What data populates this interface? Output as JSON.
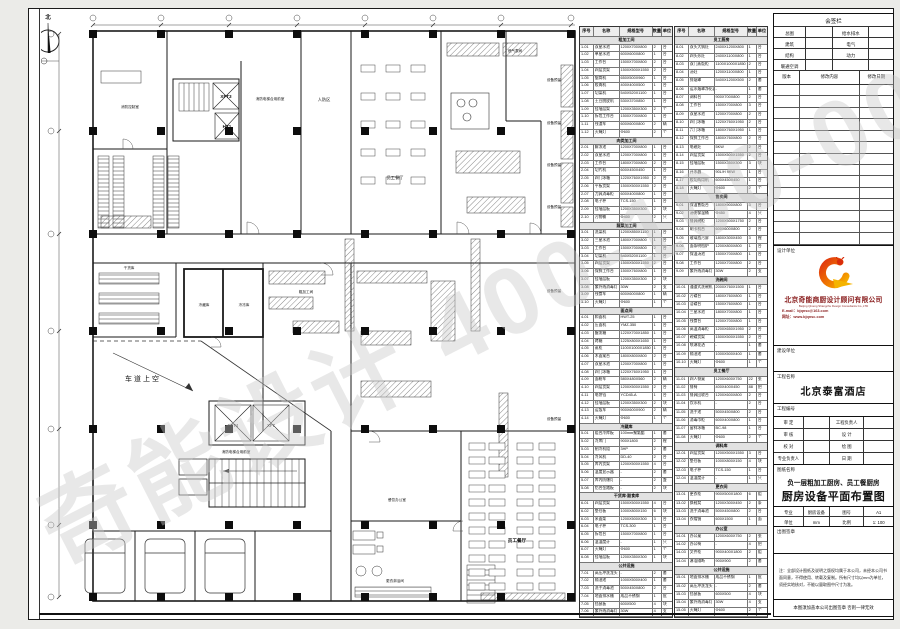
{
  "watermark": {
    "text": "奇能设计 400-100-0086"
  },
  "plan": {
    "labels": [
      {
        "t": "北"
      },
      {
        "t": "消防控制室"
      },
      {
        "t": "XFT3"
      },
      {
        "t": "HT1"
      },
      {
        "t": "消防电梯合用前室"
      },
      {
        "t": "人防区"
      },
      {
        "t": "燃气表间"
      },
      {
        "t": "员工餐厅"
      },
      {
        "t": "干货库"
      },
      {
        "t": "冷藏库"
      },
      {
        "t": "冷冻库"
      },
      {
        "t": "粗加工间"
      },
      {
        "t": "车道上空"
      },
      {
        "t": "XFT4"
      },
      {
        "t": "XF7"
      },
      {
        "t": "消防电梯合用前室"
      },
      {
        "t": "餐饮办公室"
      },
      {
        "t": "更衣淋浴间"
      },
      {
        "t": "员工餐厅"
      },
      {
        "t": "设备预留"
      },
      {
        "t": "设备预留"
      },
      {
        "t": "设备预留"
      },
      {
        "t": "设备预留"
      },
      {
        "t": "设备预留"
      },
      {
        "t": "设备预留"
      }
    ]
  },
  "schedule": {
    "headers": [
      "序号",
      "名称",
      "规格型号",
      "数量",
      "单位"
    ],
    "table1_rows": [
      [
        "粗加工间"
      ],
      [
        "1-01",
        "双星水池",
        "1200X700X800",
        "2",
        "台"
      ],
      [
        "1-02",
        "单星水池",
        "600X600X800",
        "1",
        "台"
      ],
      [
        "1-03",
        "工作台",
        "1500X700X800",
        "2",
        "台"
      ],
      [
        "1-04",
        "四层货架",
        "1500X500X1550",
        "2",
        "台"
      ],
      [
        "1-05",
        "锯骨机",
        "650X500X960",
        "1",
        "台"
      ],
      [
        "1-06",
        "绞肉机",
        "400X400X500",
        "1",
        "台"
      ],
      [
        "1-07",
        "切菜机",
        "540X520X1100",
        "1",
        "台"
      ],
      [
        "1-08",
        "土豆脱皮机",
        "530X370X850",
        "1",
        "台"
      ],
      [
        "1-09",
        "挂墙层架",
        "1200X350X300",
        "2",
        "个"
      ],
      [
        "1-10",
        "拆包工作台",
        "1500X700X800",
        "1",
        "台"
      ],
      [
        "1-11",
        "残渣车",
        "600X600X800",
        "2",
        "辆"
      ],
      [
        "1-12",
        "灭蝇灯",
        "Φ600",
        "2",
        "个"
      ],
      [
        "肉类加工间"
      ],
      [
        "2-01",
        "解冻池",
        "1200X700X800",
        "1",
        "台"
      ],
      [
        "2-02",
        "双星水池",
        "1200X700X800",
        "1",
        "台"
      ],
      [
        "2-03",
        "工作台",
        "1800X700X800",
        "2",
        "台"
      ],
      [
        "2-04",
        "切片机",
        "600X450X450",
        "1",
        "台"
      ],
      [
        "2-05",
        "四门冰箱",
        "1220X760X1950",
        "2",
        "台"
      ],
      [
        "2-06",
        "平板货架",
        "1500X500X1550",
        "2",
        "台"
      ],
      [
        "2-07",
        "刀具消毒柜",
        "600X400X800",
        "1",
        "台"
      ],
      [
        "2-08",
        "电子秤",
        "TCS-150",
        "1",
        "台"
      ],
      [
        "2-09",
        "挂墙层板",
        "1200X350X300",
        "2",
        "块"
      ],
      [
        "2-10",
        "污物桶",
        "Φ400",
        "2",
        "只"
      ],
      [
        "蔬菜加工间"
      ],
      [
        "3-01",
        "洗菜机",
        "1200X850X1150",
        "1",
        "台"
      ],
      [
        "3-02",
        "三星水池",
        "1800X700X800",
        "1",
        "台"
      ],
      [
        "3-03",
        "工作台",
        "1500X700X800",
        "2",
        "台"
      ],
      [
        "3-04",
        "切菜机",
        "540X520X1100",
        "1",
        "台"
      ],
      [
        "3-05",
        "四层货架",
        "1500X500X1550",
        "2",
        "台"
      ],
      [
        "3-06",
        "保鲜工作台",
        "1500X760X800",
        "1",
        "台"
      ],
      [
        "3-07",
        "挂墙层板",
        "1200X350X300",
        "2",
        "块"
      ],
      [
        "3-08",
        "紫外线消毒灯",
        "30W",
        "2",
        "支"
      ],
      [
        "3-09",
        "残食车",
        "600X600X800",
        "1",
        "辆"
      ],
      [
        "3-10",
        "灭蝇灯",
        "Φ600",
        "1",
        "个"
      ],
      [
        "面点间"
      ],
      [
        "4-01",
        "和面机",
        "HWT-25",
        "1",
        "台"
      ],
      [
        "4-02",
        "压面机",
        "YMZ-350",
        "1",
        "台"
      ],
      [
        "4-03",
        "醒发箱",
        "1220X700X1850",
        "1",
        "台"
      ],
      [
        "4-04",
        "烤箱",
        "1225X800X1650",
        "1",
        "台"
      ],
      [
        "4-05",
        "蒸柜",
        "1100X1000X1850",
        "1",
        "台"
      ],
      [
        "4-06",
        "木面案台",
        "1800X800X800",
        "2",
        "台"
      ],
      [
        "4-07",
        "双星水池",
        "1200X700X800",
        "1",
        "台"
      ],
      [
        "4-08",
        "四门冰箱",
        "1220X760X1950",
        "1",
        "台"
      ],
      [
        "4-09",
        "面粉车",
        "580X480X560",
        "2",
        "辆"
      ],
      [
        "4-10",
        "四层货架",
        "1200X500X1550",
        "2",
        "台"
      ],
      [
        "4-11",
        "电饼铛",
        "YCD45-A",
        "1",
        "台"
      ],
      [
        "4-12",
        "挂墙层板",
        "1200X350X300",
        "2",
        "块"
      ],
      [
        "4-13",
        "运饭车",
        "900X600X900",
        "2",
        "辆"
      ],
      [
        "4-14",
        "灭蝇灯",
        "Φ600",
        "1",
        "个"
      ],
      [
        "冷藏库"
      ],
      [
        "5-01",
        "组合冷库板",
        "100mm聚氨酯",
        "1",
        "套"
      ],
      [
        "5-02",
        "冷库门",
        "900X1800",
        "2",
        "樘"
      ],
      [
        "5-03",
        "制冷机组",
        "3HP",
        "2",
        "套"
      ],
      [
        "5-04",
        "冷风机",
        "DD-40",
        "2",
        "台"
      ],
      [
        "5-05",
        "库内货架",
        "1200X500X1550",
        "4",
        "台"
      ],
      [
        "5-06",
        "温度显示器",
        "-",
        "2",
        "套"
      ],
      [
        "5-07",
        "库内防爆灯",
        "-",
        "2",
        "盏"
      ],
      [
        "5-08",
        "铝合金踏板",
        "-",
        "2",
        "块"
      ],
      [
        "干货库·副食库"
      ],
      [
        "6-01",
        "四层货架",
        "1500X500X1550",
        "4",
        "台"
      ],
      [
        "6-02",
        "垫仓板",
        "1000X800X150",
        "6",
        "块"
      ],
      [
        "6-03",
        "米面架",
        "1200X500X300",
        "3",
        "台"
      ],
      [
        "6-04",
        "电子秤",
        "TCS-300",
        "1",
        "台"
      ],
      [
        "6-05",
        "拆包台",
        "1500X700X800",
        "1",
        "台"
      ],
      [
        "6-06",
        "温湿度计",
        "-",
        "1",
        "只"
      ],
      [
        "6-07",
        "灭蝇灯",
        "Φ600",
        "1",
        "个"
      ],
      [
        "6-08",
        "挂墙层板",
        "1200X350X300",
        "1",
        "块"
      ],
      [
        "公共设施"
      ],
      [
        "7-01",
        "高压冲洗龙头",
        "-",
        "2",
        "套"
      ],
      [
        "7-02",
        "隔油池",
        "1000X500X400",
        "1",
        "套"
      ],
      [
        "7-03",
        "洗手消毒池",
        "500X450X800",
        "2",
        "台"
      ],
      [
        "7-04",
        "地面排水槽",
        "成品不锈钢",
        "1",
        "批"
      ],
      [
        "7-05",
        "挡鼠板",
        "600X500",
        "4",
        "块"
      ],
      [
        "7-06",
        "紫外线消毒灯",
        "30W",
        "4",
        "支"
      ]
    ],
    "table2_rows": [
      [
        "员工厨房"
      ],
      [
        "8-01",
        "双头大锅灶",
        "2400X1200X800",
        "1",
        "台"
      ],
      [
        "8-02",
        "四头炒灶",
        "2400X1100X800",
        "1",
        "台"
      ],
      [
        "8-03",
        "双门蒸饭柜",
        "1100X1000X1850",
        "2",
        "台"
      ],
      [
        "8-04",
        "汤灶",
        "1200X1100X800",
        "1",
        "台"
      ],
      [
        "8-05",
        "排烟罩",
        "5400X1200X500",
        "2",
        "套"
      ],
      [
        "8-06",
        "运水烟罩净化器",
        "-",
        "1",
        "套"
      ],
      [
        "8-07",
        "调料台",
        "900X700X800",
        "2",
        "台"
      ],
      [
        "8-08",
        "工作台",
        "1500X700X800",
        "3",
        "台"
      ],
      [
        "8-09",
        "双星水池",
        "1200X700X800",
        "2",
        "台"
      ],
      [
        "8-10",
        "四门冰箱",
        "1220X760X1950",
        "2",
        "台"
      ],
      [
        "8-11",
        "六门冰箱",
        "1800X760X1950",
        "1",
        "台"
      ],
      [
        "8-12",
        "保鲜工作台",
        "1800X760X800",
        "2",
        "台"
      ],
      [
        "8-13",
        "电磁灶",
        "5KW",
        "2",
        "台"
      ],
      [
        "8-14",
        "四层货架",
        "1500X500X1550",
        "2",
        "台"
      ],
      [
        "8-15",
        "挂墙层板",
        "1500X350X300",
        "3",
        "块"
      ],
      [
        "8-16",
        "开水器",
        "90L/H 9KW",
        "1",
        "台"
      ],
      [
        "8-17",
        "绞切两用机",
        "600X450X450",
        "1",
        "台"
      ],
      [
        "8-18",
        "灭蝇灯",
        "Φ600",
        "2",
        "个"
      ],
      [
        "售卖间"
      ],
      [
        "9-01",
        "保温售饭台",
        "1800X900X800",
        "3",
        "台"
      ],
      [
        "9-02",
        "汤粥保温桶",
        "Φ450",
        "4",
        "只"
      ],
      [
        "9-03",
        "餐具碗柜",
        "1200X500X1750",
        "2",
        "台"
      ],
      [
        "9-04",
        "刷卡机台",
        "600X600X800",
        "2",
        "台"
      ],
      [
        "9-05",
        "玻璃挡污屏",
        "1800X300X450",
        "3",
        "樘"
      ],
      [
        "9-06",
        "面条明档炉",
        "1200X800X800",
        "1",
        "台"
      ],
      [
        "9-07",
        "保温汤池",
        "1500X700X800",
        "1",
        "台"
      ],
      [
        "9-08",
        "工作台",
        "1200X700X800",
        "2",
        "台"
      ],
      [
        "9-09",
        "紫外线消毒灯",
        "30W",
        "2",
        "支"
      ],
      [
        "洗碗间"
      ],
      [
        "10-01",
        "通道式洗碗机",
        "2000X760X1500",
        "1",
        "台"
      ],
      [
        "10-02",
        "污碟台",
        "1800X760X800",
        "1",
        "台"
      ],
      [
        "10-03",
        "洁碟台",
        "1500X760X800",
        "1",
        "台"
      ],
      [
        "10-04",
        "三星水池",
        "1800X700X800",
        "1",
        "台"
      ],
      [
        "10-05",
        "残食台",
        "1200X700X800",
        "1",
        "台"
      ],
      [
        "10-06",
        "高温消毒柜",
        "1200X650X1950",
        "2",
        "台"
      ],
      [
        "10-07",
        "碗碟货架",
        "1500X500X1550",
        "2",
        "台"
      ],
      [
        "10-08",
        "喷淋花洒",
        "-",
        "1",
        "套"
      ],
      [
        "10-09",
        "隔油池",
        "1000X500X400",
        "1",
        "套"
      ],
      [
        "10-10",
        "灭蝇灯",
        "Φ600",
        "1",
        "个"
      ],
      [
        "员工餐厅"
      ],
      [
        "11-01",
        "四人餐桌",
        "1200X600X750",
        "22",
        "张"
      ],
      [
        "11-02",
        "餐椅",
        "400X400X450",
        "88",
        "把"
      ],
      [
        "11-03",
        "餐具回收台",
        "1200X600X800",
        "2",
        "台"
      ],
      [
        "11-04",
        "饮水机",
        "-",
        "2",
        "台"
      ],
      [
        "11-05",
        "洗手池",
        "500X450X800",
        "2",
        "台"
      ],
      [
        "11-06",
        "消毒巾柜",
        "600X400X800",
        "1",
        "台"
      ],
      [
        "11-07",
        "留样冰箱",
        "BC-98",
        "1",
        "台"
      ],
      [
        "11-08",
        "灭蝇灯",
        "Φ600",
        "2",
        "个"
      ],
      [
        "调料库"
      ],
      [
        "12-01",
        "四层货架",
        "1200X500X1550",
        "3",
        "台"
      ],
      [
        "12-02",
        "垫仓板",
        "1000X800X150",
        "4",
        "块"
      ],
      [
        "12-03",
        "电子秤",
        "TCS-150",
        "1",
        "台"
      ],
      [
        "12-04",
        "温湿度计",
        "-",
        "1",
        "只"
      ],
      [
        "更衣间"
      ],
      [
        "13-01",
        "更衣柜",
        "900X500X1800",
        "6",
        "组"
      ],
      [
        "13-02",
        "换鞋凳",
        "1200X300X450",
        "2",
        "条"
      ],
      [
        "13-03",
        "洗手消毒池",
        "500X450X800",
        "2",
        "台"
      ],
      [
        "13-04",
        "衣帽镜",
        "600X1500",
        "1",
        "面"
      ],
      [
        "办公室"
      ],
      [
        "14-01",
        "办公桌",
        "1200X600X750",
        "2",
        "张"
      ],
      [
        "14-02",
        "办公椅",
        "-",
        "4",
        "把"
      ],
      [
        "14-03",
        "文件柜",
        "900X400X1800",
        "2",
        "组"
      ],
      [
        "14-04",
        "淋浴隔断",
        "900X900",
        "2",
        "套"
      ],
      [
        "公共设施"
      ],
      [
        "15-01",
        "地面排水槽",
        "成品不锈钢",
        "1",
        "批"
      ],
      [
        "15-02",
        "高压冲洗龙头",
        "-",
        "2",
        "套"
      ],
      [
        "15-03",
        "挡鼠板",
        "600X500",
        "4",
        "块"
      ],
      [
        "15-04",
        "紫外线消毒灯",
        "30W",
        "4",
        "支"
      ],
      [
        "15-05",
        "灭蝇灯",
        "Φ600",
        "2",
        "个"
      ]
    ]
  },
  "titleblock": {
    "sign_table": {
      "title": "会签栏",
      "rows": [
        [
          "总图",
          "给水排水"
        ],
        [
          "建筑",
          "电气"
        ],
        [
          "结构",
          "动力"
        ],
        [
          "暖通空调",
          ""
        ]
      ],
      "rev_headers": [
        "版本",
        "修改内容",
        "修改日期"
      ]
    },
    "design_unit_label": "设计单位",
    "company_cn": "北京奇能商厨设计顾问有限公司",
    "company_en": "Beijing Qineng Shangchu Design Consultants Co.,LTD",
    "email": "E-mail：bjqnsc@163.com",
    "website": "网址：www.bjqnsc.com",
    "build_unit_label": "建设单位",
    "project_name_label": "工程名称",
    "project_name": "北京泰富酒店",
    "project_no_label": "工程编号",
    "sign_rows": [
      [
        "审 定",
        "工程负责人"
      ],
      [
        "审 核",
        "设 计"
      ],
      [
        "校 对",
        "绘 图"
      ],
      [
        "专业负责人",
        "日 期"
      ]
    ],
    "drawing_name_label": "图纸名称",
    "drawing_subtitle": "负一层粗加工厨房、员工餐厨房",
    "drawing_title": "厨房设备平面布置图",
    "meta_rows": [
      [
        "专业",
        "厨房设备",
        "图号",
        "A1"
      ],
      [
        "单位",
        "mm",
        "比例",
        "1: 100"
      ]
    ],
    "seal_label": "出图签章",
    "notes": "注：全部设计图纸及说明之版权均属于本公司，未经本公司书面同意，不得使用、转载及复制。所有尺寸均以mm为单位，须经实地核对，不能以量取图中尺寸为准。",
    "seal_notice": "本图须加盖本公司出图签章 否则一律无效"
  }
}
